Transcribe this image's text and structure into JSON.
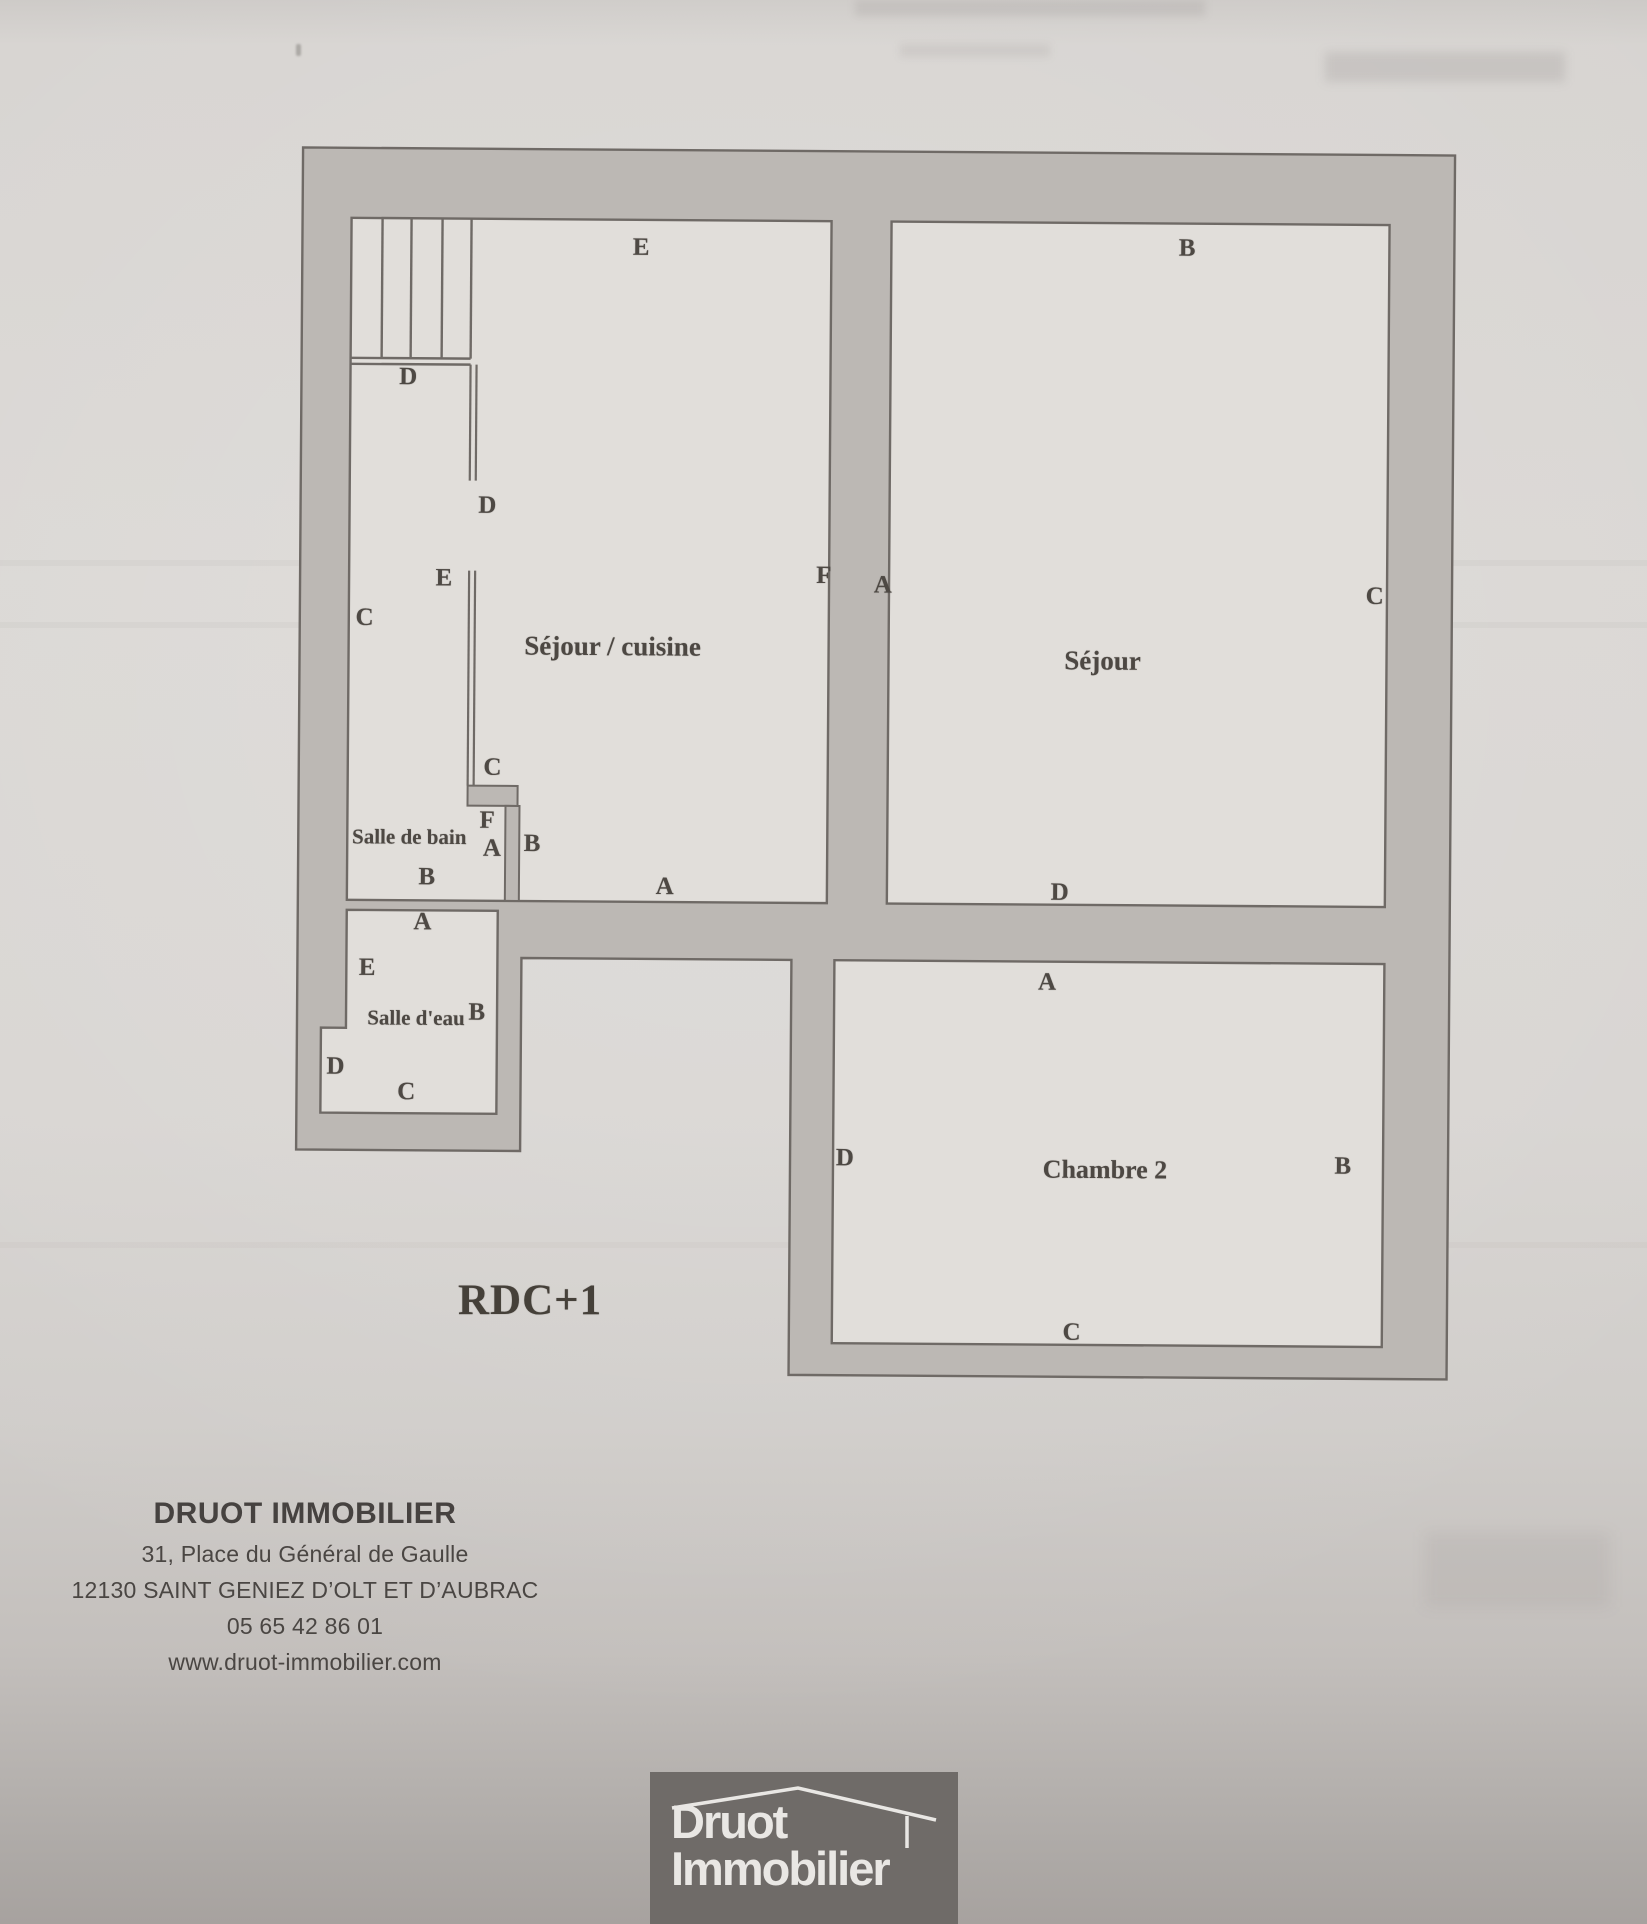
{
  "page": {
    "floor_label": "RDC+1",
    "agency": {
      "name": "DRUOT IMMOBILIER",
      "address_line1": "31, Place du Général de Gaulle",
      "address_line2": "12130 SAINT GENIEZ D’OLT ET D’AUBRAC",
      "phone": "05 65 42 86 01",
      "website": "www.druot-immobilier.com"
    },
    "logo": {
      "word1": "Druot",
      "word2": "Immobilier",
      "icon": "roof-outline-icon"
    },
    "colors": {
      "paper": "#d8d5d2",
      "room_fill": "#e1dedา",
      "wall_fill": "#bcb8b4",
      "wall_line": "#6f6a66",
      "ink": "#4e4944",
      "logo_bg": "#6f6b68",
      "logo_fg": "#e9e7e4"
    }
  },
  "plan": {
    "rooms": [
      {
        "id": "sejour-cuisine",
        "name": "Séjour / cuisine",
        "x": 616,
        "y": 645,
        "size": 27
      },
      {
        "id": "sejour",
        "name": "Séjour",
        "x": 1106,
        "y": 656,
        "size": 27
      },
      {
        "id": "salle-de-bain",
        "name": "Salle de bain",
        "x": 414,
        "y": 837,
        "size": 21
      },
      {
        "id": "salle-deau",
        "name": "Salle d'eau",
        "x": 422,
        "y": 1018,
        "size": 21
      },
      {
        "id": "chambre-2",
        "name": "Chambre 2",
        "x": 1112,
        "y": 1165,
        "size": 26
      }
    ],
    "wall_labels": [
      {
        "t": "E",
        "x": 642,
        "y": 246
      },
      {
        "t": "B",
        "x": 1188,
        "y": 243
      },
      {
        "t": "D",
        "x": 410,
        "y": 377
      },
      {
        "t": "D",
        "x": 490,
        "y": 505
      },
      {
        "t": "E",
        "x": 447,
        "y": 578
      },
      {
        "t": "C",
        "x": 368,
        "y": 618
      },
      {
        "t": "F",
        "x": 827,
        "y": 573
      },
      {
        "t": "A",
        "x": 886,
        "y": 582
      },
      {
        "t": "C",
        "x": 1378,
        "y": 590
      },
      {
        "t": "C",
        "x": 497,
        "y": 767
      },
      {
        "t": "F",
        "x": 492,
        "y": 820
      },
      {
        "t": "A",
        "x": 497,
        "y": 848
      },
      {
        "t": "B",
        "x": 537,
        "y": 843
      },
      {
        "t": "B",
        "x": 432,
        "y": 877
      },
      {
        "t": "A",
        "x": 670,
        "y": 885
      },
      {
        "t": "D",
        "x": 1065,
        "y": 888
      },
      {
        "t": "A",
        "x": 1053,
        "y": 978
      },
      {
        "t": "A",
        "x": 428,
        "y": 922
      },
      {
        "t": "E",
        "x": 373,
        "y": 968
      },
      {
        "t": "B",
        "x": 483,
        "y": 1012
      },
      {
        "t": "D",
        "x": 342,
        "y": 1067
      },
      {
        "t": "C",
        "x": 413,
        "y": 1092
      },
      {
        "t": "D",
        "x": 852,
        "y": 1155
      },
      {
        "t": "B",
        "x": 1350,
        "y": 1160
      },
      {
        "t": "C",
        "x": 1080,
        "y": 1328
      }
    ]
  }
}
